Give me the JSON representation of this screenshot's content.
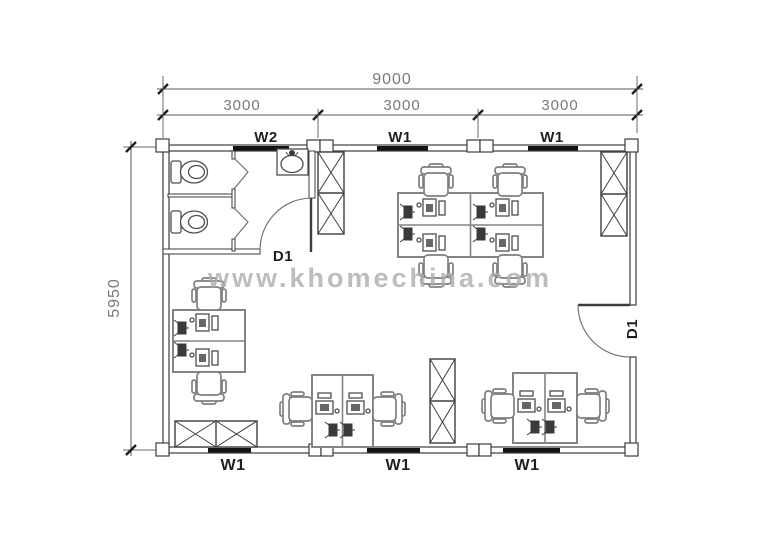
{
  "drawing": {
    "type": "office-floor-plan",
    "watermark": "www.khomechina.com",
    "dimensions": {
      "total_width": "9000",
      "bay_widths": [
        "3000",
        "3000",
        "3000"
      ],
      "total_height": "5950"
    },
    "labels": {
      "top_openings": [
        "W2",
        "W1",
        "W1"
      ],
      "bottom_openings": [
        "W1",
        "W1",
        "W1"
      ],
      "doors": [
        "D1",
        "D1"
      ]
    },
    "colors": {
      "wall_line": "#3c3c3c",
      "dimension_text": "#7a7a7a",
      "opening_label_text": "#1f1f1f",
      "window_fill": "#141414",
      "furniture_line": "#848484",
      "watermark": "#adadad",
      "background": "#ffffff"
    }
  }
}
